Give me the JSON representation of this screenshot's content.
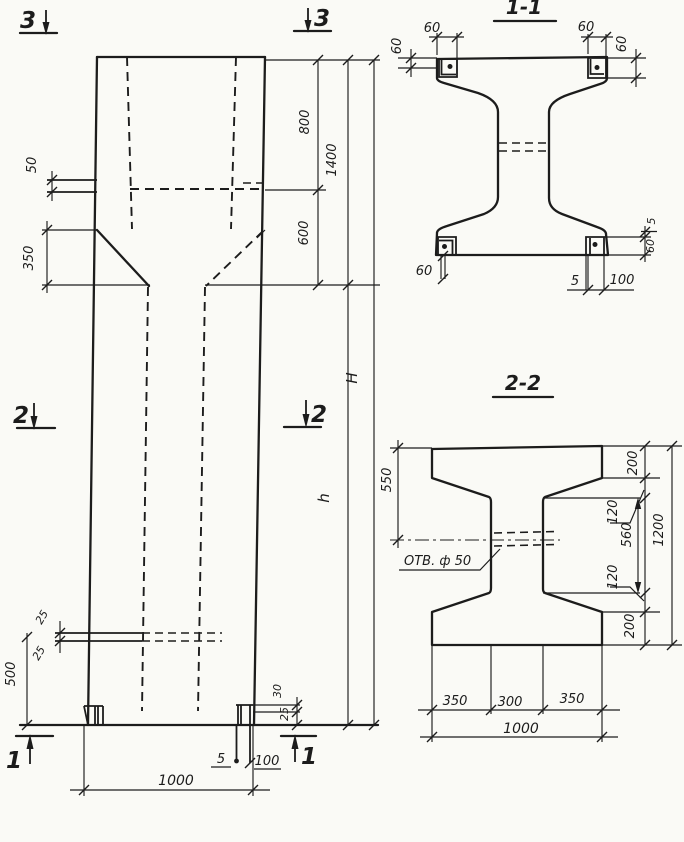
{
  "theme": {
    "paper": "#fafaf6",
    "ink": "#1c1c1c"
  },
  "markers": {
    "m1": "1",
    "m2": "2",
    "m3": "3"
  },
  "elevation": {
    "d50": "50",
    "d350": "350",
    "d800": "800",
    "d1400": "1400",
    "d600": "600",
    "dH": "H",
    "dh": "h",
    "d25_top": "25",
    "d25_bot": "25",
    "d500": "500",
    "d30": "30",
    "d25_foot": "25",
    "d5": "5",
    "d100": "100",
    "d1000": "1000"
  },
  "section_1_1": {
    "title": "1-1",
    "d60_top_left_w": "60",
    "d60_top_left_h": "60",
    "d60_top_right_w": "60",
    "d60_top_right_h": "60",
    "d60_bottom_left": "60",
    "d5_side": "5",
    "d60_side": "60",
    "d5_bottom": "5",
    "d100_bottom": "100"
  },
  "section_2_2": {
    "title": "2-2",
    "hole_label": "ОТВ. ф 50",
    "d550": "550",
    "d200_top": "200",
    "d120_top": "120",
    "d560": "560",
    "d120_bottom": "120",
    "d200_bottom": "200",
    "d1200": "1200",
    "d350_left": "350",
    "d300": "300",
    "d350_right": "350",
    "d1000": "1000"
  }
}
